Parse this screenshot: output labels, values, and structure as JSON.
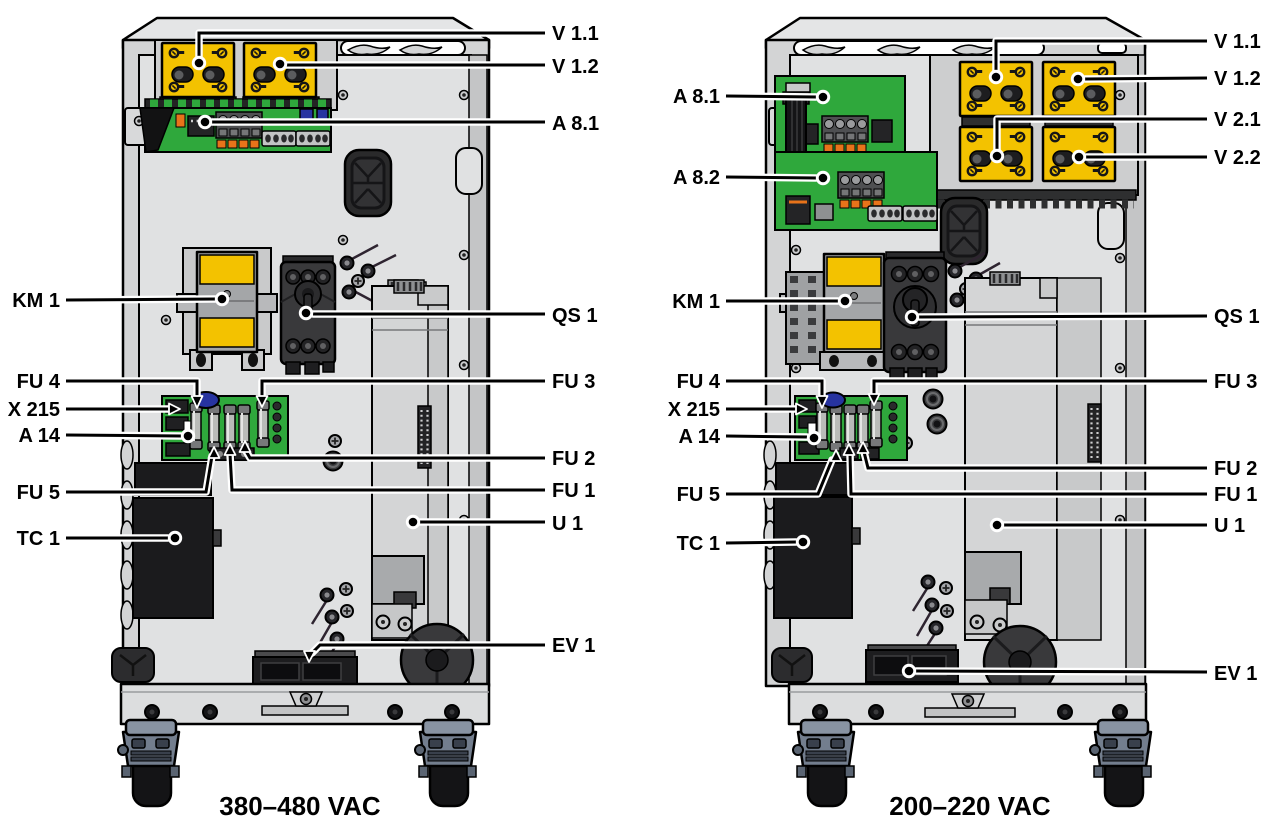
{
  "diagram": {
    "title": "drive-cabinet-component-location-diagram",
    "left_unit": {
      "caption": "380–480 VAC",
      "labels": {
        "v1_1": "V 1.1",
        "v1_2": "V 1.2",
        "a8_1": "A 8.1",
        "km1": "KM 1",
        "qs1": "QS 1",
        "fu4": "FU 4",
        "x215": "X 215",
        "a14": "A 14",
        "fu3": "FU 3",
        "fu2": "FU 2",
        "fu1": "FU 1",
        "fu5": "FU 5",
        "tc1": "TC 1",
        "u1": "U 1",
        "ev1": "EV 1"
      }
    },
    "right_unit": {
      "caption": "200–220 VAC",
      "labels": {
        "v1_1": "V 1.1",
        "v1_2": "V 1.2",
        "v2_1": "V 2.1",
        "v2_2": "V 2.2",
        "a8_1": "A 8.1",
        "a8_2": "A 8.2",
        "km1": "KM 1",
        "qs1": "QS 1",
        "fu4": "FU 4",
        "x215": "X 215",
        "a14": "A 14",
        "fu3": "FU 3",
        "fu2": "FU 2",
        "fu1": "FU 1",
        "fu5": "FU 5",
        "tc1": "TC 1",
        "u1": "U 1",
        "ev1": "EV 1"
      }
    },
    "colors": {
      "module_yellow": "#F3C200",
      "pcb_green": "#2FA83C",
      "connector_blue": "#2733A0",
      "connector_orange": "#E8731A",
      "caster_gray": "#76808F",
      "cabinet_gray": "#D3D4D5"
    }
  }
}
